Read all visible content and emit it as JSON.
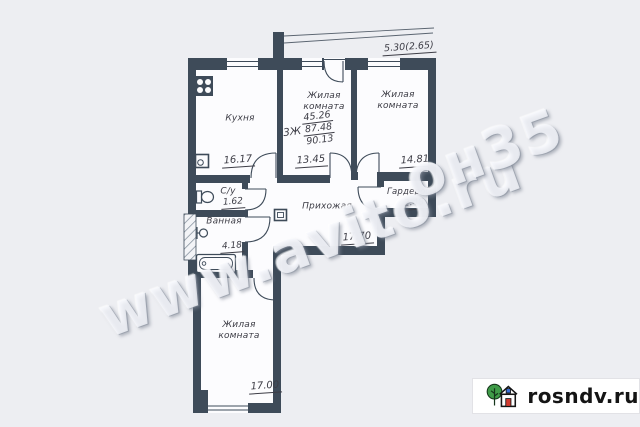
{
  "colors": {
    "background": "#edeef2",
    "floor": "#fcfcfe",
    "wall": "#3e4b59",
    "text": "#3d3d46",
    "logo_bg": "#ffffff",
    "logo_text": "#141414",
    "logo_tree_green": "#3f9b48",
    "logo_door_red": "#d23b30",
    "logo_window_blue": "#3a6fd8"
  },
  "plan": {
    "dimension_top": "5.30(2.65)",
    "summary": {
      "type": "3Ж",
      "living_area": "45.26",
      "area": "87.48",
      "total_area": "90.13"
    },
    "rooms": [
      {
        "label": "Кухня",
        "area": "16.17"
      },
      {
        "label": "Жилая комната",
        "area": "13.45"
      },
      {
        "label": "Жилая комната",
        "area": "14.81"
      },
      {
        "label": "С/у",
        "area": "1.62"
      },
      {
        "label": "Ванная",
        "area": "4.18"
      },
      {
        "label": "Прихожая",
        "area": "17.70"
      },
      {
        "label": "Гардероб",
        "area": "2.48"
      },
      {
        "label": "Жилая комната",
        "area": "17.00"
      }
    ],
    "icons": [
      "stove-icon",
      "sink-icon",
      "toilet-icon",
      "towel-dryer-icon",
      "bathtub-icon",
      "electrical-panel-icon"
    ]
  },
  "watermark": {
    "main": "www.avito.ru",
    "fragment": "он35"
  },
  "logo": {
    "site": "rosndv.ru",
    "icon": "house-with-tree-icon"
  }
}
